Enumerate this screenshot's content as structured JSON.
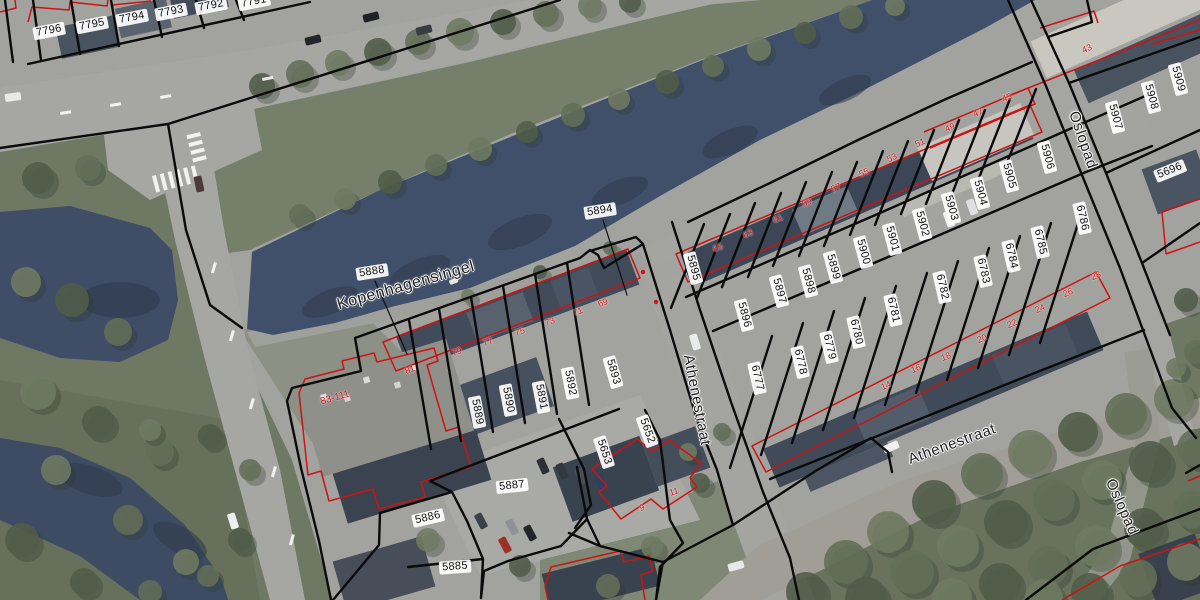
{
  "map": {
    "type": "aerial-cadastral-map",
    "colors": {
      "parcel_line": "#0b0b0b",
      "building_outline": "#cf1212",
      "label_text": "#111111",
      "water": "#41506a",
      "road": "#a6a7a2",
      "grass": "#6e7863"
    },
    "streets": [
      {
        "name": "Kopenhagensingel",
        "x": 406,
        "y": 286,
        "rot": -16,
        "size": 16
      },
      {
        "name": "Athenestraat",
        "x": 697,
        "y": 400,
        "rot": 79,
        "size": 15
      },
      {
        "name": "Athenestraat",
        "x": 952,
        "y": 444,
        "rot": -20,
        "size": 15
      },
      {
        "name": "Oslopad",
        "x": 1083,
        "y": 140,
        "rot": 71,
        "size": 15
      },
      {
        "name": "Oslopad",
        "x": 1122,
        "y": 507,
        "rot": 66,
        "size": 15
      }
    ],
    "parcel_labels": [
      {
        "id": "7796",
        "x": 49,
        "y": 31,
        "rot": -11
      },
      {
        "id": "7795",
        "x": 92,
        "y": 25,
        "rot": -11
      },
      {
        "id": "7794",
        "x": 132,
        "y": 18,
        "rot": -11
      },
      {
        "id": "7793",
        "x": 171,
        "y": 12,
        "rot": -11
      },
      {
        "id": "7792",
        "x": 211,
        "y": 6,
        "rot": -11
      },
      {
        "id": "7791",
        "x": 254,
        "y": 2,
        "rot": -11
      },
      {
        "id": "5888",
        "x": 372,
        "y": 272,
        "rot": -9
      },
      {
        "id": "5894",
        "x": 600,
        "y": 211,
        "rot": -9
      },
      {
        "id": "5889",
        "x": 477,
        "y": 412,
        "rot": 79
      },
      {
        "id": "5890",
        "x": 508,
        "y": 400,
        "rot": 79
      },
      {
        "id": "5891",
        "x": 541,
        "y": 397,
        "rot": 79
      },
      {
        "id": "5892",
        "x": 570,
        "y": 383,
        "rot": 79
      },
      {
        "id": "5893",
        "x": 613,
        "y": 372,
        "rot": 74
      },
      {
        "id": "5652",
        "x": 647,
        "y": 431,
        "rot": 70
      },
      {
        "id": "5653",
        "x": 604,
        "y": 452,
        "rot": 72
      },
      {
        "id": "5887",
        "x": 512,
        "y": 486,
        "rot": -6
      },
      {
        "id": "5886",
        "x": 428,
        "y": 518,
        "rot": -13
      },
      {
        "id": "5885",
        "x": 455,
        "y": 567,
        "rot": -4
      },
      {
        "id": "5895",
        "x": 693,
        "y": 268,
        "rot": 75
      },
      {
        "id": "5896",
        "x": 744,
        "y": 315,
        "rot": 75
      },
      {
        "id": "5897",
        "x": 779,
        "y": 291,
        "rot": 75
      },
      {
        "id": "5898",
        "x": 808,
        "y": 281,
        "rot": 75
      },
      {
        "id": "5899",
        "x": 833,
        "y": 267,
        "rot": 75
      },
      {
        "id": "5900",
        "x": 863,
        "y": 252,
        "rot": 75
      },
      {
        "id": "5901",
        "x": 892,
        "y": 239,
        "rot": 75
      },
      {
        "id": "5902",
        "x": 922,
        "y": 224,
        "rot": 75
      },
      {
        "id": "5903",
        "x": 951,
        "y": 208,
        "rot": 75
      },
      {
        "id": "5904",
        "x": 980,
        "y": 193,
        "rot": 75
      },
      {
        "id": "5905",
        "x": 1009,
        "y": 176,
        "rot": 75
      },
      {
        "id": "5906",
        "x": 1047,
        "y": 157,
        "rot": 75
      },
      {
        "id": "5907",
        "x": 1115,
        "y": 117,
        "rot": 75
      },
      {
        "id": "5908",
        "x": 1151,
        "y": 97,
        "rot": 75
      },
      {
        "id": "5909",
        "x": 1178,
        "y": 79,
        "rot": 75
      },
      {
        "id": "5696",
        "x": 1170,
        "y": 171,
        "rot": -22
      },
      {
        "id": "6786",
        "x": 1082,
        "y": 218,
        "rot": 77
      },
      {
        "id": "6785",
        "x": 1040,
        "y": 242,
        "rot": 77
      },
      {
        "id": "6784",
        "x": 1011,
        "y": 256,
        "rot": 77
      },
      {
        "id": "6783",
        "x": 983,
        "y": 271,
        "rot": 77
      },
      {
        "id": "6782",
        "x": 942,
        "y": 287,
        "rot": 77
      },
      {
        "id": "6781",
        "x": 893,
        "y": 310,
        "rot": 77
      },
      {
        "id": "6780",
        "x": 856,
        "y": 332,
        "rot": 77
      },
      {
        "id": "6779",
        "x": 829,
        "y": 347,
        "rot": 77
      },
      {
        "id": "6778",
        "x": 800,
        "y": 362,
        "rot": 77
      },
      {
        "id": "6777",
        "x": 757,
        "y": 378,
        "rot": 77
      }
    ],
    "house_number_labels": [
      {
        "n": "81",
        "x": 410,
        "y": 370,
        "rot": -21
      },
      {
        "n": "79",
        "x": 457,
        "y": 352,
        "rot": -21
      },
      {
        "n": "77",
        "x": 488,
        "y": 342,
        "rot": -21
      },
      {
        "n": "75",
        "x": 520,
        "y": 332,
        "rot": -21
      },
      {
        "n": "73",
        "x": 550,
        "y": 322,
        "rot": -21
      },
      {
        "n": "71",
        "x": 578,
        "y": 312,
        "rot": -21
      },
      {
        "n": "69",
        "x": 603,
        "y": 303,
        "rot": -21
      },
      {
        "n": "65",
        "x": 718,
        "y": 248,
        "rot": -23
      },
      {
        "n": "63",
        "x": 748,
        "y": 234,
        "rot": -23
      },
      {
        "n": "61",
        "x": 778,
        "y": 219,
        "rot": -23
      },
      {
        "n": "59",
        "x": 807,
        "y": 203,
        "rot": -23
      },
      {
        "n": "57",
        "x": 836,
        "y": 188,
        "rot": -23
      },
      {
        "n": "55",
        "x": 864,
        "y": 173,
        "rot": -23
      },
      {
        "n": "53",
        "x": 892,
        "y": 158,
        "rot": -23
      },
      {
        "n": "51",
        "x": 920,
        "y": 143,
        "rot": -23
      },
      {
        "n": "49",
        "x": 950,
        "y": 128,
        "rot": -23
      },
      {
        "n": "47",
        "x": 978,
        "y": 113,
        "rot": -23
      },
      {
        "n": "45",
        "x": 1007,
        "y": 98,
        "rot": -23
      },
      {
        "n": "43",
        "x": 1087,
        "y": 49,
        "rot": -23
      },
      {
        "n": "28",
        "x": 1096,
        "y": 276,
        "rot": -23
      },
      {
        "n": "26",
        "x": 1068,
        "y": 293,
        "rot": -23
      },
      {
        "n": "24",
        "x": 1040,
        "y": 309,
        "rot": -23
      },
      {
        "n": "22",
        "x": 1012,
        "y": 324,
        "rot": -23
      },
      {
        "n": "20",
        "x": 982,
        "y": 339,
        "rot": -23
      },
      {
        "n": "18",
        "x": 946,
        "y": 357,
        "rot": -23
      },
      {
        "n": "16",
        "x": 916,
        "y": 369,
        "rot": -23
      },
      {
        "n": "14",
        "x": 886,
        "y": 386,
        "rot": -23
      },
      {
        "n": "11",
        "x": 674,
        "y": 492,
        "rot": -18
      },
      {
        "n": "9",
        "x": 642,
        "y": 508,
        "rot": -18
      },
      {
        "n": "83-111",
        "x": 335,
        "y": 398,
        "rot": -16
      }
    ]
  }
}
